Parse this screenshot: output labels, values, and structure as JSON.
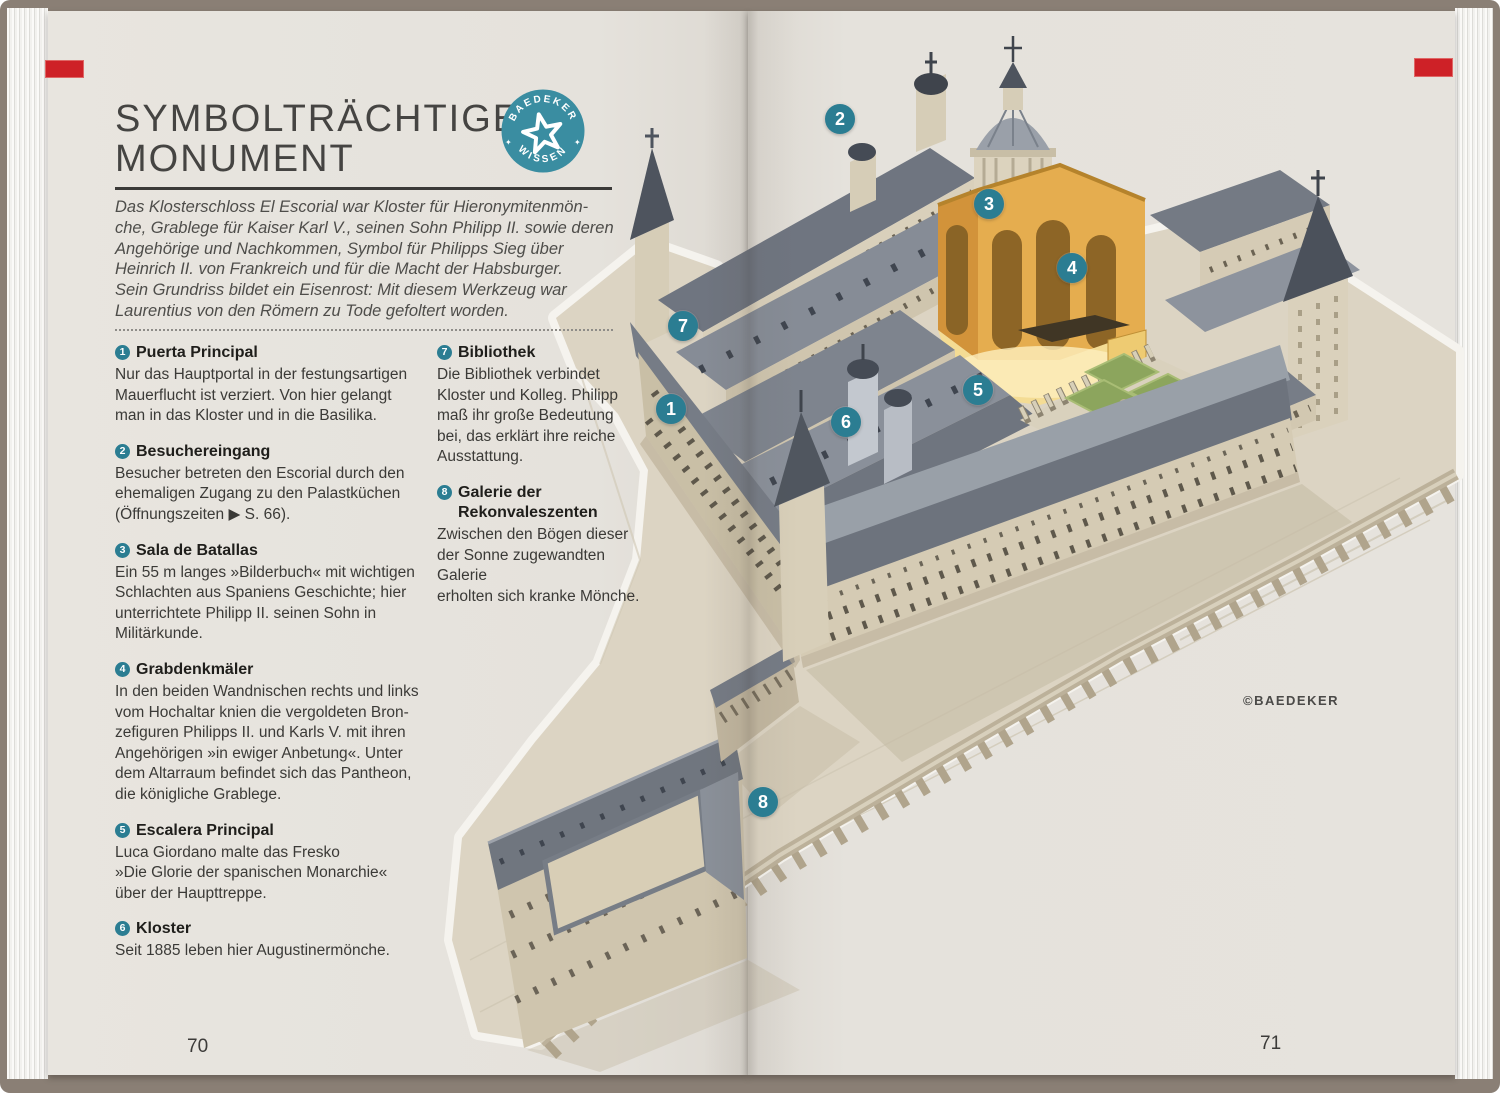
{
  "book": {
    "left_page_number": "70",
    "right_page_number": "71",
    "credit": "©BAEDEKER"
  },
  "badge": {
    "arc_top": "BAEDEKER",
    "arc_bottom": "WISSEN",
    "side_symbol": "✦"
  },
  "header": {
    "title_line1": "SYMBOLTRÄCHTIGES",
    "title_line2": "MONUMENT"
  },
  "intro_lines": [
    "Das Klosterschloss El Escorial war Kloster für Hieronymitenmön-",
    "che, Grablege für Kaiser Karl V., seinen Sohn Philipp II. sowie deren",
    "Angehörige und Nachkommen, Symbol für Philipps Sieg über",
    "Heinrich II. von Frankreich und für die Macht der Habsburger.",
    "Sein Grundriss bildet ein Eisenrost: Mit diesem Werkzeug war",
    "Laurentius von den Römern zu Tode gefoltert worden."
  ],
  "legend": {
    "items": [
      {
        "num": "1",
        "title": "Puerta Principal",
        "body_lines": [
          "Nur das Hauptportal in der festungsartigen",
          "Mauerflucht ist verziert. Von hier gelangt",
          "man in das Kloster und in die Basilika."
        ]
      },
      {
        "num": "2",
        "title": "Besuchereingang",
        "body_lines": [
          "Besucher betreten den Escorial durch den",
          "ehemaligen Zugang zu den Palastküchen",
          "(Öffnungszeiten ▶ S. 66)."
        ]
      },
      {
        "num": "3",
        "title": "Sala de Batallas",
        "body_lines": [
          "Ein 55 m langes »Bilderbuch« mit wichtigen",
          "Schlachten aus Spaniens Geschichte; hier",
          "unterrichtete Philipp II. seinen Sohn in",
          "Militärkunde."
        ]
      },
      {
        "num": "4",
        "title": "Grabdenkmäler",
        "body_lines": [
          "In den beiden Wandnischen rechts und links",
          "vom Hochaltar knien die vergoldeten Bron-",
          "zefiguren Philipps II. und Karls V. mit ihren",
          "Angehörigen »in ewiger Anbetung«. Unter",
          "dem Altarraum befindet sich das Pantheon,",
          "die königliche Grablege."
        ]
      },
      {
        "num": "5",
        "title": "Escalera Principal",
        "body_lines": [
          "Luca Giordano malte das Fresko",
          "»Die Glorie der spanischen Monarchie«",
          "über der Haupttreppe."
        ]
      },
      {
        "num": "6",
        "title": "Kloster",
        "body_lines": [
          "Seit 1885 leben hier Augustinermönche."
        ]
      },
      {
        "num": "7",
        "title": "Bibliothek",
        "body_lines": [
          "Die Bibliothek verbindet",
          "Kloster und Kolleg. Philipp",
          "maß ihr große Bedeutung",
          "bei, das erklärt ihre reiche",
          "Ausstattung."
        ]
      },
      {
        "num": "8",
        "title": "Galerie der\nRekonvaleszenten",
        "body_lines": [
          "Zwischen den Bögen dieser",
          "der Sonne zugewandten Galerie",
          "erholten sich kranke Mönche."
        ]
      }
    ]
  },
  "map": {
    "subject": "El Escorial cutaway bird's-eye illustration",
    "markers": [
      {
        "label": "1",
        "x": 671,
        "y": 409
      },
      {
        "label": "2",
        "x": 840,
        "y": 119
      },
      {
        "label": "3",
        "x": 989,
        "y": 204
      },
      {
        "label": "4",
        "x": 1072,
        "y": 268
      },
      {
        "label": "5",
        "x": 978,
        "y": 390
      },
      {
        "label": "6",
        "x": 846,
        "y": 422
      },
      {
        "label": "7",
        "x": 683,
        "y": 326
      },
      {
        "label": "8",
        "x": 763,
        "y": 802
      }
    ]
  },
  "colors": {
    "accent_teal": "#2b7d92",
    "badge_teal": "#3a8da1",
    "tab_red": "#ce2127",
    "gold_wall": "#e5ad4f",
    "roof_gray": "#767c86",
    "wall_beige": "#d3c9b2",
    "garden_green": "#8ca55d",
    "page_bg": "#e6e3dd"
  }
}
